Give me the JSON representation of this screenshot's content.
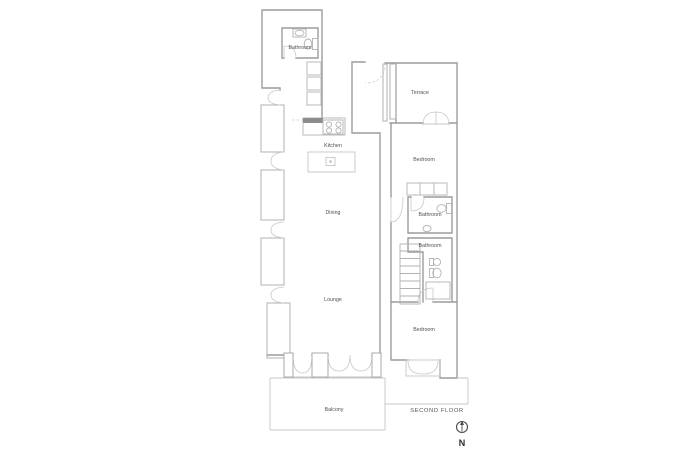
{
  "plan": {
    "title": "SECOND FLOOR",
    "colors": {
      "wall": "#9c9c9c",
      "light_line": "#c6c6c6",
      "fixture": "#b3b3b3",
      "counter_hatch": "#8d8d8d",
      "label_text": "#4f4f4f"
    },
    "rooms": [
      {
        "id": "bathroom-top",
        "label": "Bathroom"
      },
      {
        "id": "terrace",
        "label": "Terrace"
      },
      {
        "id": "kitchen",
        "label": "Kitchen"
      },
      {
        "id": "bedroom-north",
        "label": "Bedroom"
      },
      {
        "id": "dining",
        "label": "Dining"
      },
      {
        "id": "bathroom-middle",
        "label": "Bathroom"
      },
      {
        "id": "bathroom-lower",
        "label": "Bathroom"
      },
      {
        "id": "lounge",
        "label": "Lounge"
      },
      {
        "id": "bedroom-south",
        "label": "Bedroom"
      },
      {
        "id": "balcony",
        "label": "Balcony"
      }
    ],
    "annotations": {
      "floor_label": "SECOND FLOOR",
      "north_label": "N"
    },
    "fixtures": [
      "stove",
      "kitchen-island",
      "kitchen-cabinets",
      "toilet x3",
      "sink x3",
      "wardrobe",
      "stairs",
      "shower",
      "planter",
      "north-arrow"
    ]
  }
}
